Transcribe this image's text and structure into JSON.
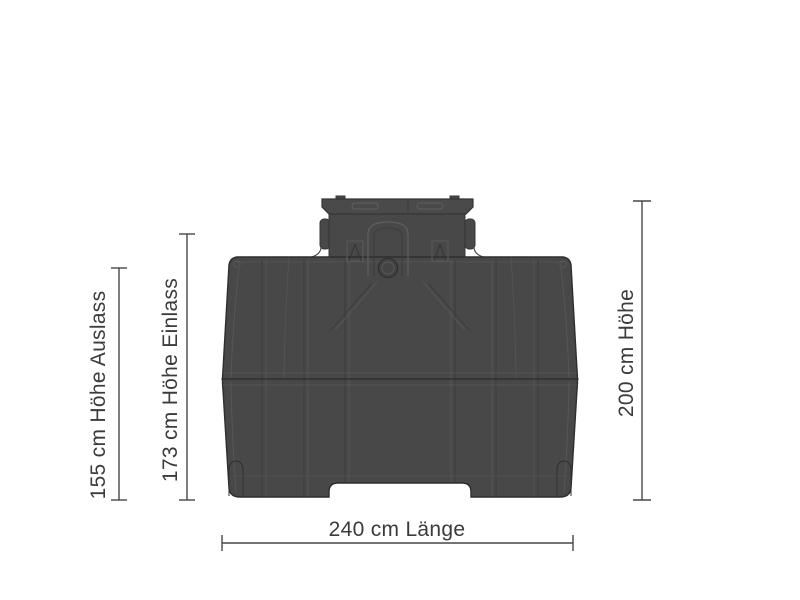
{
  "diagram": {
    "figure": "tank-front-view",
    "colors": {
      "background": "#ffffff",
      "tank_fill": "#484848",
      "tank_line_dark": "#343434",
      "tank_line_light": "#5a5a5a",
      "dimension_line": "#474747",
      "label_text": "#3b3b3b"
    },
    "dimensions": [
      {
        "id": "outlet-height",
        "value": 155,
        "unit": "cm",
        "name": "Höhe Auslass",
        "label": "155 cm Höhe Auslass",
        "orientation": "vertical"
      },
      {
        "id": "inlet-height",
        "value": 173,
        "unit": "cm",
        "name": "Höhe Einlass",
        "label": "173 cm Höhe Einlass",
        "orientation": "vertical"
      },
      {
        "id": "total-height",
        "value": 200,
        "unit": "cm",
        "name": "Höhe",
        "label": "200 cm Höhe",
        "orientation": "vertical"
      },
      {
        "id": "length",
        "value": 240,
        "unit": "cm",
        "name": "Länge",
        "label": "240 cm Länge",
        "orientation": "horizontal"
      }
    ]
  }
}
